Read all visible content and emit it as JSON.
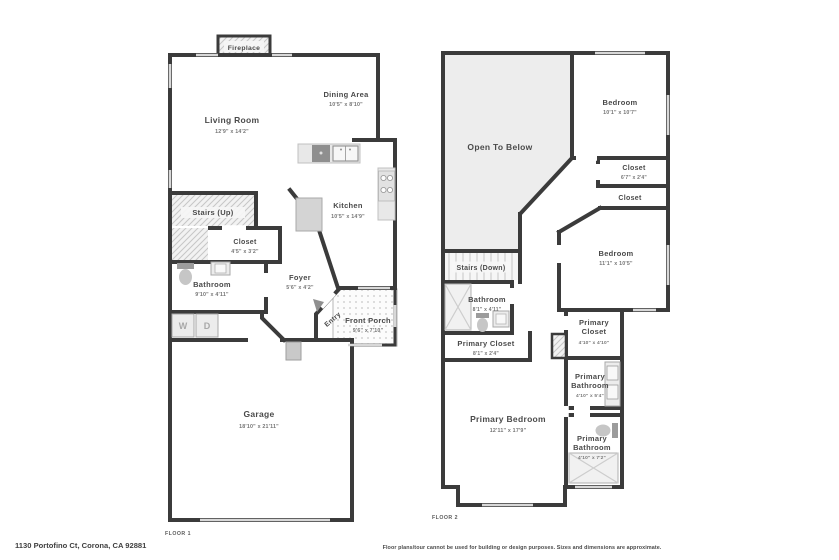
{
  "footer": {
    "address": "1130 Portofino Ct, Corona, CA 92881",
    "disclaimer": "Floor plans/tour cannot be used for building or design purposes. Sizes and dimensions are approximate."
  },
  "floor1": {
    "label": "FLOOR 1",
    "rooms": {
      "fireplace": {
        "name": "Fireplace"
      },
      "living": {
        "name": "Living Room",
        "dims": "12'9\" x 14'2\""
      },
      "dining": {
        "name": "Dining Area",
        "dims": "10'5\" x 8'10\""
      },
      "kitchen": {
        "name": "Kitchen",
        "dims": "10'5\" x 14'9\""
      },
      "stairs": {
        "name": "Stairs (Up)"
      },
      "closet": {
        "name": "Closet",
        "dims": "4'5\" x 3'2\""
      },
      "bathroom": {
        "name": "Bathroom",
        "dims": "9'10\" x 4'11\""
      },
      "foyer": {
        "name": "Foyer",
        "dims": "5'6\" x 4'2\""
      },
      "entry": {
        "name": "Entry"
      },
      "porch": {
        "name": "Front Porch",
        "dims": "9'6\" x 7'10\""
      },
      "garage": {
        "name": "Garage",
        "dims": "18'10\" x 21'11\""
      },
      "washer": {
        "name": "W"
      },
      "dryer": {
        "name": "D"
      }
    }
  },
  "floor2": {
    "label": "FLOOR 2",
    "rooms": {
      "open_to_below": {
        "name": "Open To Below"
      },
      "bedroom1": {
        "name": "Bedroom",
        "dims": "10'1\" x 10'7\""
      },
      "closet1": {
        "name": "Closet",
        "dims": "6'7\" x 2'4\""
      },
      "closet2": {
        "name": "Closet"
      },
      "stairs": {
        "name": "Stairs (Down)"
      },
      "bathroom": {
        "name": "Bathroom",
        "dims": "8'1\" x 4'11\""
      },
      "bedroom2": {
        "name": "Bedroom",
        "dims": "11'1\" x 10'5\""
      },
      "primary_closet1": {
        "name": "Primary Closet",
        "dims": "8'1\" x 2'4\""
      },
      "primary_closet2": {
        "line1": "Primary",
        "line2": "Closet",
        "dims": "4'10\" x 4'10\""
      },
      "primary_bathroom1": {
        "line1": "Primary",
        "line2": "Bathroom",
        "dims": "4'10\" x 5'4\""
      },
      "primary_bedroom": {
        "name": "Primary Bedroom",
        "dims": "12'11\" x 17'9\""
      },
      "primary_bathroom2": {
        "line1": "Primary",
        "line2": "Bathroom",
        "dims": "4'10\" x 7'2\""
      }
    }
  },
  "colors": {
    "wall": "#3b3b3b",
    "open_to_below_fill": "#ededed",
    "hatch_fill": "#f2f2f2",
    "window": "#d8d8d8",
    "room_text": "#4a4a4a",
    "dim_text": "#757575"
  }
}
